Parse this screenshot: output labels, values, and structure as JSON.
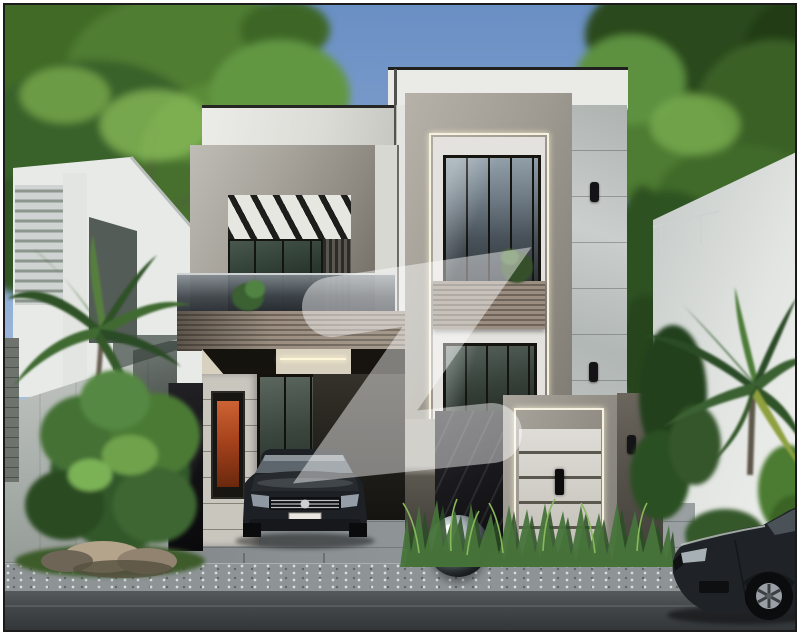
{
  "meta": {
    "title": "3D exterior render of a modern two-storey grey house with watermark",
    "text_content": "none — image contains no readable text",
    "watermark": {
      "glyph": "Z",
      "style": "translucent white logo watermark",
      "opacity": 0.45
    }
  },
  "palette": {
    "border": "#1b1b1b",
    "sky_top": "#6a8fc4",
    "sky_bottom": "#ccdaea",
    "foliage_dark": "#2b4a1c",
    "foliage_mid": "#4f7d30",
    "foliage_light": "#86b858",
    "concrete_light": "#b6b2a9",
    "concrete_dark": "#7e7a72",
    "fascia_white": "#eaeae6",
    "panel_wall": "#cbd0cf",
    "wood_light": "#9b8e80",
    "wood_dark": "#6e6459",
    "glass_sky": "#93a1ab",
    "glass_dark": "#131a15",
    "stone_wall": "#c9c6be",
    "black_marble": "#141416",
    "gate_panel": "#dedcd6",
    "led_strip": "#f7f2e0",
    "artwork_orange": "#cd6434",
    "boundary_wall_left": "#aab0ac",
    "neighbor_wall_right": "#f0f1ef",
    "pavement": "#8b9193",
    "gravel": "#8e9496",
    "road": "#43474a",
    "car_body": "#1d2024",
    "chrome": "#c9ccd0"
  },
  "scene": {
    "sky": "clear blue sky",
    "background": {
      "left_tree": "large leafy tree",
      "right_tree": "leafy tree",
      "left_neighbor": "white house with louvered screen and sloped glass",
      "right_neighbor": "white neighbor wall with thin railing"
    },
    "house": {
      "style": "modern two-storey grey villa",
      "left_block": "concrete box frame with recessed balcony, angled black louvers, glass balustrade",
      "wood_band": "horizontal wood-slat balcony band",
      "right_tower": "tall concrete frame with LED edge light, double-height window, wood planter, lower window",
      "porch": "car porch with lit ceiling cove and orange artwork window",
      "entrance_gate": "grey panelled gate in LED-lit concrete frame with black handle",
      "pillars": "black marble pillar and dark stone gate pillar",
      "sconces": "three black wall lights"
    },
    "foreground": {
      "left_bush": "green shrub with rocks on grass",
      "palms": "palm trees left and right",
      "grass_bed": "ornamental grasses in front of gate",
      "sphere": "mirror-polished steel sphere",
      "car_porch": "dark sedan parked under porch",
      "car_street": "dark sedan parked on street at right",
      "driveway": "grey paved driveway",
      "road": "asphalt road with gravel verge"
    }
  }
}
